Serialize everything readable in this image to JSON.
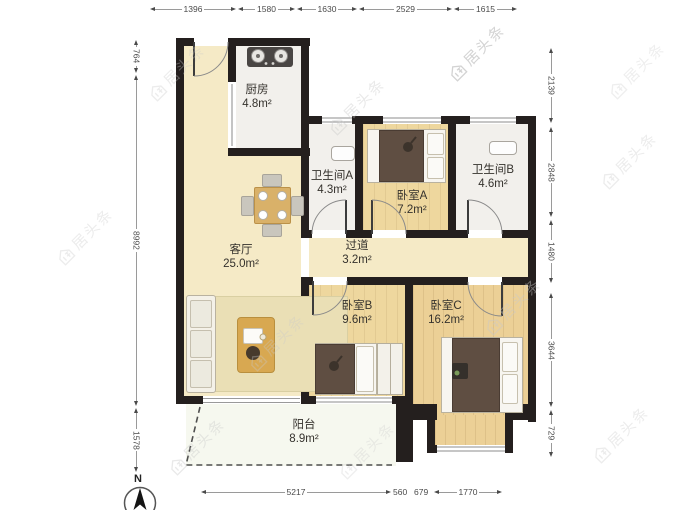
{
  "watermark": {
    "text": "居头条"
  },
  "compass": {
    "label": "N"
  },
  "rooms": {
    "kitchen": {
      "name": "厨房",
      "area": "4.8m²"
    },
    "bath_a": {
      "name": "卫生间A",
      "area": "4.3m²"
    },
    "bed_a": {
      "name": "卧室A",
      "area": "7.2m²"
    },
    "bath_b": {
      "name": "卫生间B",
      "area": "4.6m²"
    },
    "living": {
      "name": "客厅",
      "area": "25.0m²"
    },
    "hallway": {
      "name": "过道",
      "area": "3.2m²"
    },
    "bed_b": {
      "name": "卧室B",
      "area": "9.6m²"
    },
    "bed_c": {
      "name": "卧室C",
      "area": "16.2m²"
    },
    "balcony": {
      "name": "阳台",
      "area": "8.9m²"
    }
  },
  "dims": {
    "top": [
      "1396",
      "1580",
      "1630",
      "2529",
      "1615"
    ],
    "bottom": [
      "5217",
      "560",
      "679",
      "1770"
    ],
    "left": [
      "764",
      "8992",
      "1578"
    ],
    "right": [
      "2139",
      "2848",
      "1480",
      "3644",
      "729"
    ]
  },
  "colors": {
    "wall": "#241f1e",
    "living_floor": "#f5eac6",
    "wood_floor": "#eed79e",
    "wet_floor": "#f2f0ec",
    "balcony_floor": "#f6f8ef"
  }
}
